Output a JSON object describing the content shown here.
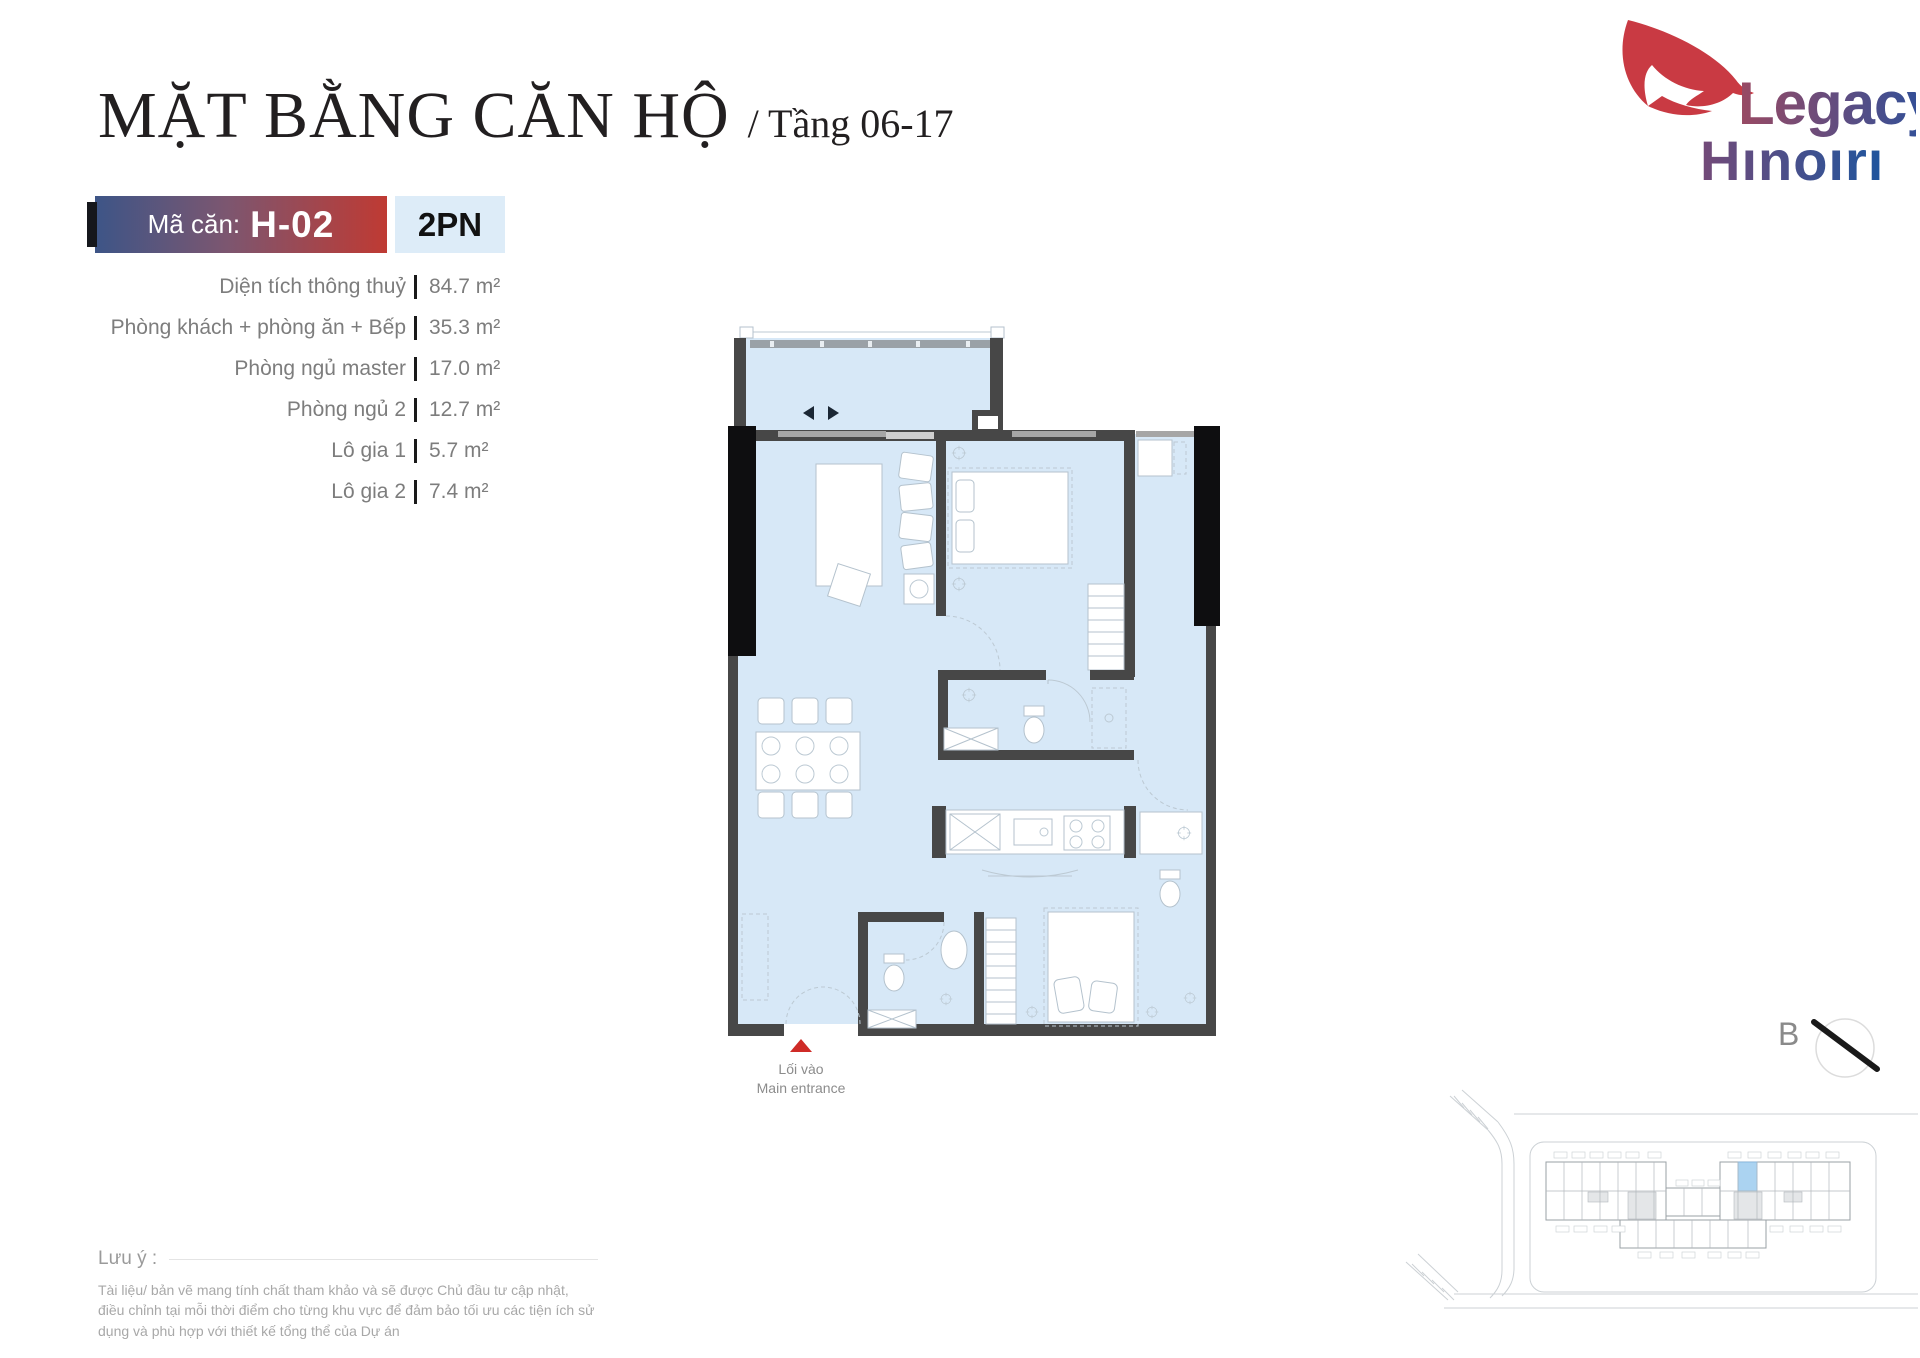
{
  "header": {
    "title": "MẶT BẰNG CĂN HỘ",
    "subtitle": "/ Tầng 06-17",
    "unit_code_label": "Mã căn:",
    "unit_code": "H-02",
    "unit_type": "2PN"
  },
  "logo": {
    "line1": "Legacy",
    "line2": "Hınoırı"
  },
  "specs": [
    {
      "label": "Diện tích thông thuỷ",
      "value": "84.7 m²"
    },
    {
      "label": "Phòng khách + phòng ăn + Bếp",
      "value": "35.3 m²"
    },
    {
      "label": "Phòng ngủ master",
      "value": "17.0 m²"
    },
    {
      "label": "Phòng ngủ 2",
      "value": "12.7 m²"
    },
    {
      "label": "Lô gia 1",
      "value": "5.7 m²"
    },
    {
      "label": "Lô gia 2",
      "value": "7.4 m²"
    }
  ],
  "floor_plan": {
    "entrance_label_vi": "Lối vào",
    "entrance_label_en": "Main entrance"
  },
  "compass": {
    "label": "B"
  },
  "note": {
    "title": "Lưu ý :",
    "body": "Tài liệu/ bản vẽ mang tính chất tham khảo và sẽ được Chủ đầu tư cập nhật, điều chỉnh tại mỗi thời điểm cho từng khu vực để đảm bảo tối ưu các tiện ích sử dụng và phù hợp với thiết kế tổng thể của Dự án"
  },
  "colors": {
    "badge_gradient_start": "#3d5587",
    "badge_gradient_end": "#bf3a33",
    "unit_type_bg": "#ddecf8",
    "floor_fill": "#d7e8f7",
    "wall": "#474747",
    "column": "#0e0e10",
    "accent_red": "#cf2b27",
    "logo_red": "#c93a43",
    "logo_blue": "#27509d",
    "highlight_unit": "#abd3f1"
  }
}
